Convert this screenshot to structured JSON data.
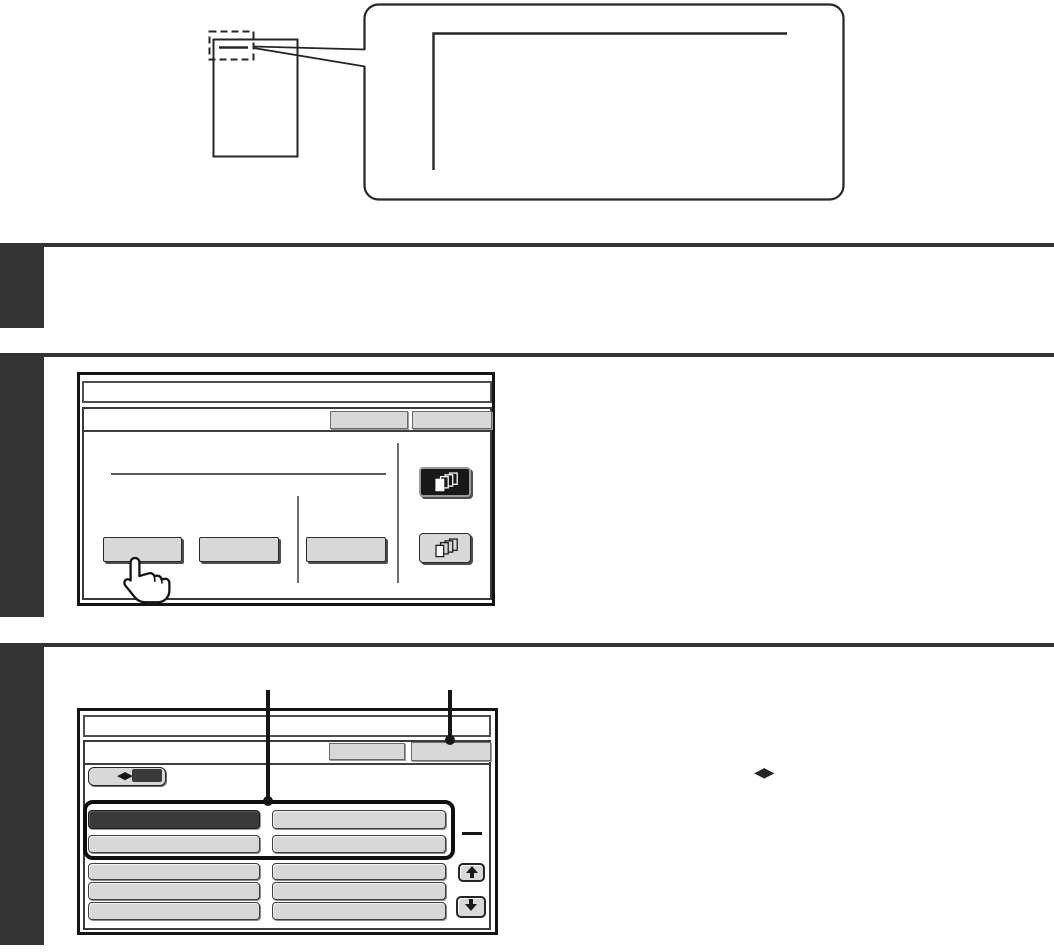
{
  "colors": {
    "section-dark": "#333333",
    "diagram-line": "#262626",
    "frame": "#141414",
    "button-fill": "#d8d8d8",
    "selected-fill": "#3a3a3a",
    "paper": "#ffffff"
  },
  "glyphs": {
    "lr_toggle": "◀▶"
  },
  "screen1": {
    "title": "",
    "top_buttons": [
      {
        "label": ""
      },
      {
        "label": ""
      }
    ],
    "action_buttons": [
      {
        "label": ""
      },
      {
        "label": ""
      },
      {
        "label": ""
      }
    ],
    "mode_buttons": [
      {
        "icon": "document-stack-icon",
        "selected": true
      },
      {
        "icon": "document-stack-icon",
        "selected": false
      }
    ]
  },
  "screen2": {
    "title": "",
    "top_buttons": [
      {
        "label": ""
      },
      {
        "label": ""
      }
    ],
    "toggle": {
      "icon": "left-right-arrows-icon"
    },
    "list": {
      "rows": [
        {
          "highlighted": true,
          "cells": [
            {
              "label": "",
              "selected": true
            },
            {
              "label": "",
              "selected": false
            }
          ]
        },
        {
          "highlighted": true,
          "cells": [
            {
              "label": "",
              "selected": false
            },
            {
              "label": "",
              "selected": false
            }
          ]
        },
        {
          "highlighted": false,
          "cells": [
            {
              "label": "",
              "selected": false
            },
            {
              "label": "",
              "selected": false
            }
          ]
        },
        {
          "highlighted": false,
          "cells": [
            {
              "label": "",
              "selected": false
            },
            {
              "label": "",
              "selected": false
            }
          ]
        },
        {
          "highlighted": false,
          "cells": [
            {
              "label": "",
              "selected": false
            },
            {
              "label": "",
              "selected": false
            }
          ]
        }
      ]
    },
    "scroll": {
      "up_icon": "up-arrow-icon",
      "down_icon": "down-arrow-icon"
    }
  }
}
